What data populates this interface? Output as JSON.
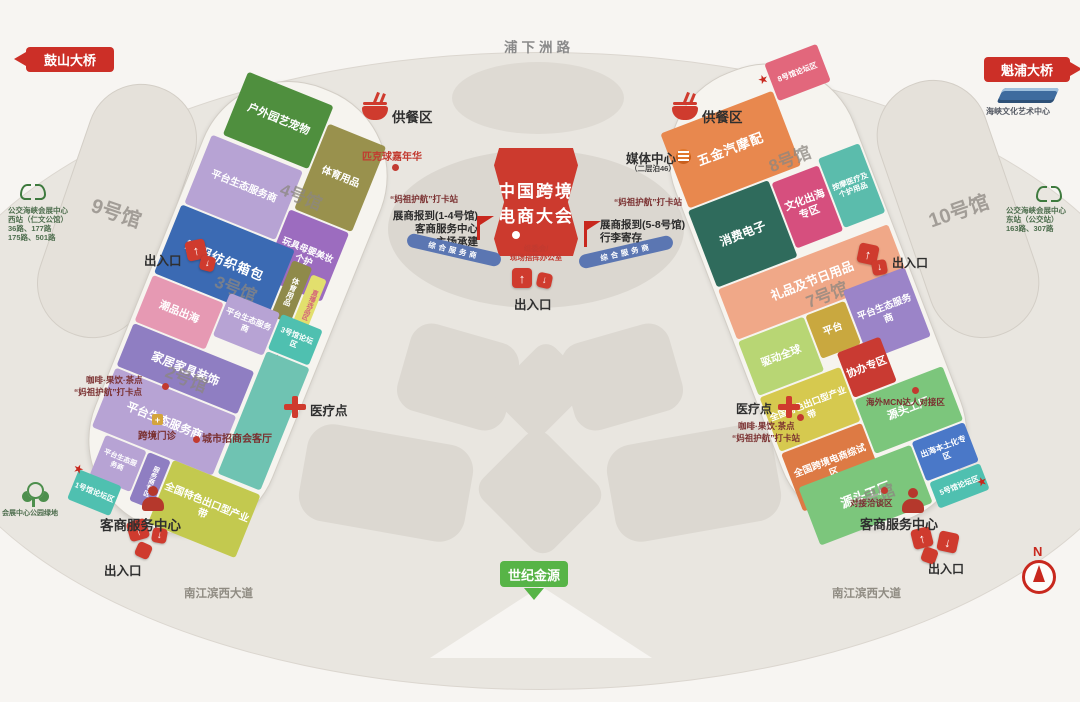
{
  "roads": {
    "top": "浦下洲路",
    "southwest": "南江滨西大道",
    "southeast": "南江滨西大道"
  },
  "bridges": {
    "west": "鼓山大桥",
    "east": "魁浦大桥"
  },
  "banner": {
    "line1": "中国跨境",
    "line2": "电商大会"
  },
  "committee": {
    "line1": "组委会/",
    "line2": "现场指挥办公室"
  },
  "labels": {
    "entrance": "出入口",
    "dining": "供餐区",
    "medical": "医疗点",
    "service_center": "客商服务中心",
    "platform_eco": "平台生态服务商",
    "service_band": "综合服务商",
    "media_center": "媒体中心",
    "media_center_note": "（二层泊46）",
    "mazu_station": "“妈祖护航”打卡站",
    "mazu_point": "“妈祖护航”打卡点",
    "pickleball": "匹克球嘉年华",
    "cafe": "咖啡·果饮·茶点",
    "clinic": "跨境门诊",
    "city_lounge": "城市招商会客厅",
    "mcn": "海外MCN达人对接区",
    "negotiation": "对接洽谈区",
    "century": "世纪金源",
    "north": "N",
    "park": "会展中心公园绿地",
    "art_center": "海峡文化艺术中心"
  },
  "registration": {
    "left": [
      "展商报到(1-4号馆)",
      "客商服务中心",
      "主场承建"
    ],
    "right": [
      "展商报到(5-8号馆)",
      "行李寄存"
    ]
  },
  "bus": {
    "west": [
      "公交海峡会展中心",
      "西站（仁文公馆）",
      "36路、177路",
      "175路、501路"
    ],
    "east": [
      "公交海峡会展中心",
      "东站（公交站）",
      "163路、307路"
    ]
  },
  "halls": {
    "h9": "9号馆",
    "h10": "10号馆",
    "h8": "8号馆",
    "h7": "7号馆",
    "h6": "6号馆",
    "h5": "5号馆",
    "h4": "4号馆",
    "h3": "3号馆",
    "h2": "2号馆",
    "h1": "1号馆"
  },
  "zones": {
    "outdoor": "户外园艺宠物",
    "sports": "体育用品",
    "toys": "玩具母婴美妆个护",
    "shoes": "鞋服纺织箱包",
    "live_strip": "直播选品区",
    "trend": "潮品出海",
    "forum3": "3号馆论坛区",
    "home": "家居家具装饰",
    "eco_strip": "服务商专区",
    "forum1": "1号馆论坛区",
    "belt": "全国特色出口型产业带",
    "forum8": "8号馆论坛区",
    "hardware": "五金汽摩配",
    "electronics": "消费电子",
    "culture": "文化出海专区",
    "massage": "按摩医疗及个护用品",
    "gifts": "礼品及节日用品",
    "drive": "驱动全球",
    "platform": "平台",
    "coorg": "协办专区",
    "pilot": "全国跨境电商综试区",
    "source": "源头工厂",
    "localization": "出海本土化专区",
    "forum5": "5号馆论坛区"
  },
  "colors": {
    "accent_red": "#cc2f27",
    "sign_green": "#57b447",
    "band_blue": "#5b76b2"
  }
}
